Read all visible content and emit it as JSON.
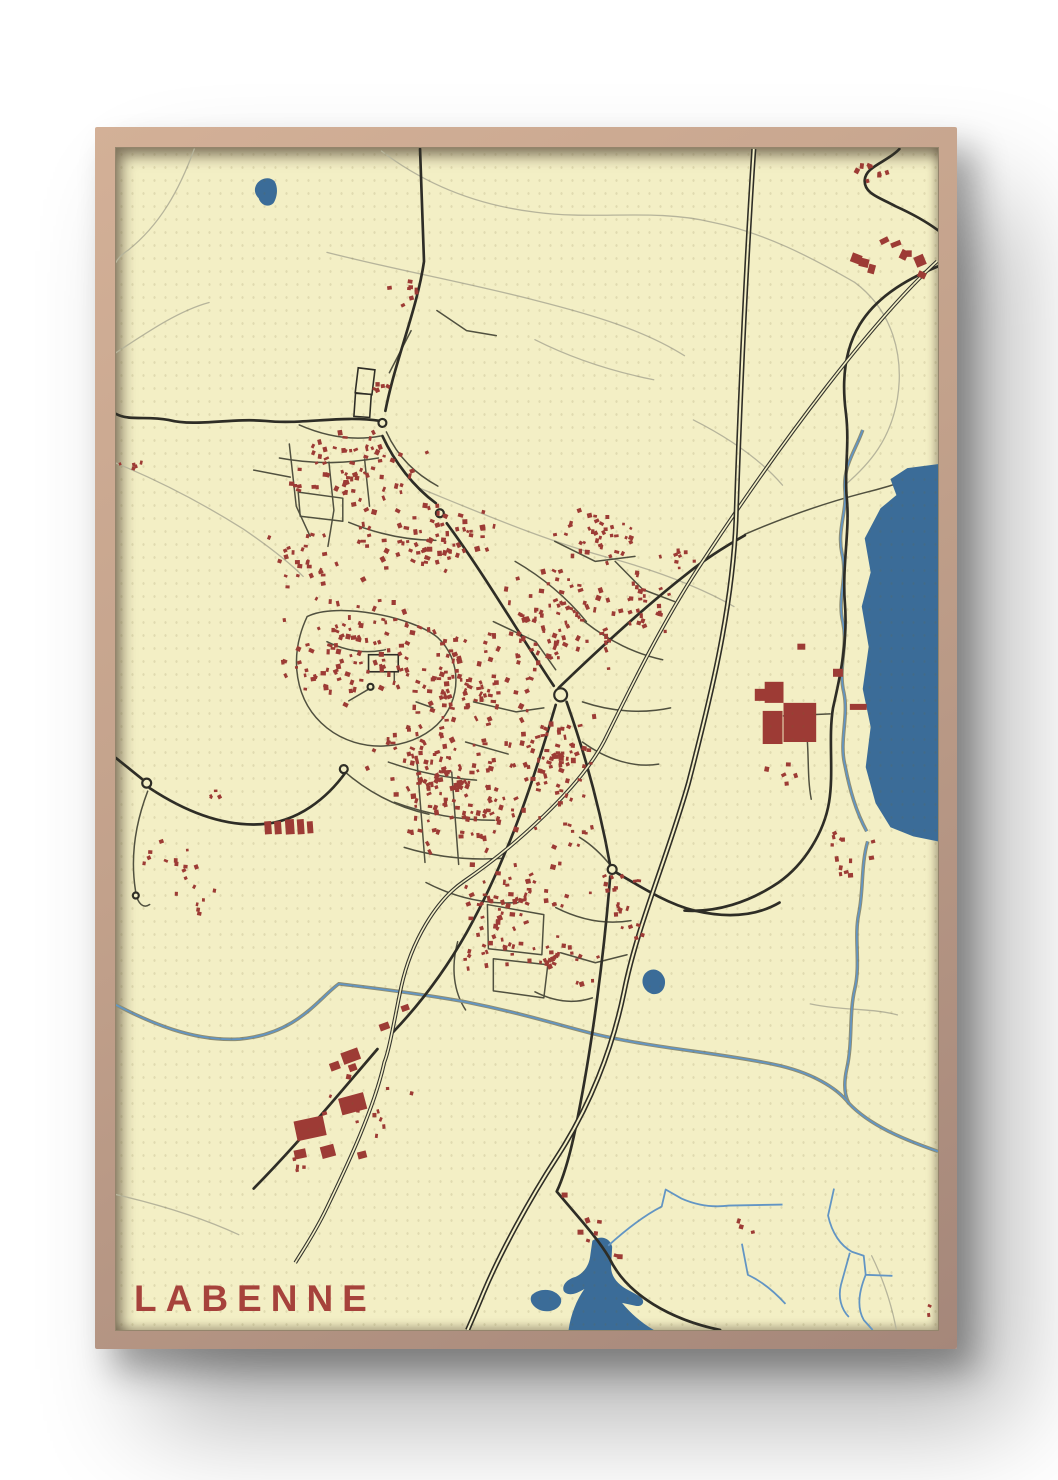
{
  "poster": {
    "title": "LABENNE"
  },
  "colors": {
    "framelight": "#d3b097",
    "framemid": "#c2a18b",
    "framedark": "#a5877a",
    "mapbg": "#f3efc5",
    "trail": "#b6b49b",
    "minor": "#50503f",
    "mainroad": "#2e2d26",
    "rail": "#33332c",
    "water": "#3b6c98",
    "stream": "#6295c4",
    "rivercase": "#8e8d72",
    "building": "#9d3b35",
    "title": "#a6423b"
  },
  "map": {
    "viewBox": "117 149 830 1178",
    "trails": [
      "M385,152 C430,186 481,206 541,213 C601,221 661,209 719,223 C771,233 821,259 863,283",
      "M863,283 C901,311 913,356 906,399 C899,439 879,463 853,485",
      "M330,253 C401,271 471,283 541,301 C601,316 651,331 691,356",
      "M421,487 C481,511 551,541 621,559 C671,573 711,589 741,606",
      "M117,463 C161,481 201,501 246,529 C271,546 291,561 306,576",
      "M196,150 C181,191 161,226 129,251 C123,255 119,259 117,263",
      "M117,353 C151,331 181,311 211,303",
      "M117,1192 C161,1202 206,1216 241,1232",
      "M880,1253 C893,1279 901,1306 905,1327",
      "M818,1002 C851,1009 881,1006 906,1013",
      "M540,340 C580,360 620,372 660,380",
      "M700,420 C740,440 770,462 790,485"
    ],
    "minor_roads": [
      "M302,425 C330,437 358,441 384,436",
      "M282,458 C320,465 352,463 382,458",
      "M292,444 L299,506 L313,536",
      "M332,462 L337,510 L331,546",
      "M368,459 L373,506",
      "M256,470 L293,477",
      "M301,492 L346,498 L346,521 L303,516 Z",
      "M390,432 C402,458 420,474 442,486",
      "M352,522 C382,534 412,540 440,540",
      "M310,616 C291,656 297,701 330,727 C363,753 413,750 441,724 C467,699 466,659 442,637 C417,616 339,601 310,616 Z",
      "M352,700 L371,689",
      "M398,681 L398,661",
      "M420,701 L437,707",
      "M330,641 C351,651 371,653 389,649",
      "M392,761 C421,771 451,777 481,779",
      "M398,801 C431,813 466,819 499,819",
      "M408,846 C441,856 473,859 506,857",
      "M421,761 L429,861",
      "M456,771 L463,863",
      "M430,881 C461,897 493,903 523,901",
      "M520,561 C548,577 572,597 592,621",
      "M560,541 L601,561 L641,556",
      "M590,621 C616,641 641,653 669,659",
      "M588,701 C618,711 649,713 677,707",
      "M588,741 C613,759 641,767 665,763",
      "M621,561 L649,589 L681,601",
      "M498,621 L541,641 L561,669",
      "M478,701 L521,711 L549,707",
      "M470,741 L513,753",
      "M492,903 L549,913 L547,953 L493,947 Z",
      "M498,957 L553,963 L549,996 L498,989 Z",
      "M561,906 C587,919 613,923 637,919",
      "M566,951 L601,961 L633,953",
      "M346,769 C371,791 401,806 433,813",
      "M149,790 C137,821 131,856 137,891 C139,903 145,907 151,903",
      "M415,331 L393,373",
      "M441,311 L471,331 L501,336",
      "M752,534 C792,517 832,503 871,493 C896,487 921,479 941,471",
      "M812,716 C818,746 814,772 819,798",
      "M838,713 L791,715",
      "M585,836 C600,845 610,856 618,866",
      "M462,940 C455,966 458,990 470,1008",
      "M540,990 C560,1000 580,1002 598,996"
    ],
    "main_roads": [
      "M424,150 L428,262 C421,310 399,360 389,411",
      "M386,436 C398,462 418,487 440,503",
      "M451,523 C487,571 525,635 559,685",
      "M561,704 C541,771 516,851 471,931 C451,966 426,1000 396,1031",
      "M381,1047 C341,1093 301,1141 256,1186",
      "M572,701 C592,757 606,809 616,864",
      "M622,871 C656,891 677,903 701,909 C731,916 761,916 787,901",
      "M616,875 C610,951 598,1041 584,1111 C575,1159 566,1181 562,1189 C584,1215 603,1235 615,1255 C633,1293 679,1317 727,1327",
      "M564,687 C606,647 650,607 694,573 C714,557 734,545 752,535",
      "M117,757 L146,780",
      "M151,787 C191,813 229,825 263,823 C301,821 331,796 349,771",
      "M947,267 C912,281 884,299 868,325 C852,351 850,383 854,413 C858,445 852,471 855,499 C858,531 850,566 853,603 C856,641 848,677 841,707 C836,737 842,771 837,801 C832,831 812,863 786,881 C756,901 723,911 691,909",
      "M908,150 C896,163 874,167 873,181 C872,195 890,199 904,207 C922,215 936,223 947,231",
      "M384,421 C344,415 306,425 268,421 C232,418 198,427 170,420 C148,416 130,421 117,414"
    ],
    "highway": "M761,150 C753,270 747,400 743,520 C739,612 716,702 695,782 C673,858 643,925 630,990 C618,1048 595,1105 562,1155 C535,1196 505,1250 488,1290 C481,1307 476,1318 472,1327",
    "railway": "M946,262 C880,322 790,440 710,560 C672,616 640,680 610,740 C585,787 520,845 468,880 C440,899 415,940 405,985 C398,1018 393,1048 388,1060 C378,1105 352,1160 330,1205 C318,1230 306,1247 298,1260",
    "rivers": [
      "M871,430 C863,452 851,466 853,490 C855,512 845,530 850,553 C856,577 845,598 851,622 C856,646 846,668 852,692 C857,716 847,740 853,764 C858,789 864,810 875,830",
      "M876,840 C869,864 872,888 867,912 C862,936 869,962 863,987 C857,1012 861,1040 855,1066 C851,1084 853,1094 857,1101",
      "M117,1003 C150,1020 195,1040 242,1037 C300,1032 322,996 342,982 C375,986 420,991 470,1000 C530,1012 560,1022 600,1032 C660,1046 720,1050 780,1062 C820,1070 845,1086 857,1101 C878,1123 912,1137 947,1149"
    ],
    "streams": [
      "M614,1243 C632,1227 652,1212 668,1204 L672,1187 L688,1196 C704,1203 720,1205 736,1203 L790,1202",
      "M842,1186 L836,1213 C840,1231 849,1243 860,1249 L872,1253 L874,1272 L901,1273",
      "M874,1272 C867,1289 865,1305 872,1317 L881,1327",
      "M858,1250 L849,1282 C846,1294 849,1306 857,1314",
      "M793,1301 C781,1288 768,1278 755,1272 L749,1241"
    ],
    "water_polygons": [
      "M947,464 L916,468 L899,479 L905,495 L889,508 L873,538 L879,572 L870,606 L877,646 L871,688 L879,726 L874,766 L884,802 L899,826 L922,835 L947,840 Z",
      "M259,185 C263,179 272,177 277,182 C281,188 280,198 276,204 C271,209 263,206 261,199 C257,195 256,190 259,185 Z",
      "M651,972 C658,964 668,968 671,977 C673,986 667,994 658,992 C649,989 646,979 651,972 Z",
      "M598,1238 C606,1232 616,1235 618,1244 L617,1262 C616,1272 622,1280 632,1286 L645,1293 C652,1297 650,1304 642,1303 L628,1300 C636,1310 648,1320 660,1327 L574,1327 C576,1312 582,1297 590,1286 C582,1291 573,1294 569,1288 C567,1282 573,1276 581,1274 C590,1270 595,1262 596,1252 Z",
      "M537,1292 C546,1284 561,1286 566,1295 C569,1303 559,1310 548,1308 C539,1306 533,1298 537,1292 Z"
    ],
    "nodes": [
      [
        386,
        423,
        4
      ],
      [
        444,
        513,
        4
      ],
      [
        566,
        694,
        6.5
      ],
      [
        148,
        782,
        4.5
      ],
      [
        347,
        768,
        4
      ],
      [
        618,
        868,
        4.5
      ],
      [
        374,
        686,
        3
      ],
      [
        398,
        659,
        3
      ],
      [
        137,
        894,
        3
      ]
    ],
    "white_rects": [
      [
        360,
        369,
        17,
        25,
        7
      ],
      [
        358,
        394,
        16,
        23,
        4
      ],
      [
        372,
        654,
        30,
        17,
        0
      ]
    ],
    "large_buildings": [
      [
        772,
        681,
        19,
        21,
        0
      ],
      [
        791,
        702,
        33,
        39,
        0
      ],
      [
        770,
        710,
        20,
        33,
        0
      ],
      [
        762,
        688,
        12,
        12,
        0
      ],
      [
        841,
        668,
        10,
        8,
        0
      ],
      [
        858,
        703,
        17,
        6,
        0
      ],
      [
        805,
        643,
        8,
        6,
        0
      ],
      [
        345,
        1048,
        18,
        12,
        -20
      ],
      [
        333,
        1060,
        10,
        8,
        -20
      ],
      [
        352,
        1062,
        8,
        7,
        -20
      ],
      [
        343,
        1093,
        26,
        17,
        -15
      ],
      [
        298,
        1116,
        30,
        20,
        -12
      ],
      [
        324,
        1143,
        14,
        12,
        -15
      ],
      [
        297,
        1147,
        12,
        9,
        -12
      ],
      [
        361,
        1149,
        9,
        7,
        -15
      ],
      [
        383,
        1021,
        10,
        7,
        -20
      ],
      [
        405,
        1003,
        8,
        6,
        -20
      ],
      [
        267,
        820,
        7,
        13,
        -4
      ],
      [
        277,
        820,
        7,
        13,
        -4
      ],
      [
        288,
        818,
        9,
        15,
        -4
      ],
      [
        300,
        818,
        7,
        15,
        -4
      ],
      [
        310,
        820,
        6,
        12,
        -4
      ],
      [
        567,
        1190,
        6,
        5,
        0
      ],
      [
        583,
        1227,
        6,
        5,
        0
      ]
    ],
    "building_clusters": [
      {
        "cx": 358,
        "cy": 468,
        "rx": 75,
        "ry": 42,
        "n": 64,
        "s": [
          2.5,
          5.5
        ]
      },
      {
        "cx": 432,
        "cy": 538,
        "rx": 85,
        "ry": 45,
        "n": 76,
        "s": [
          2.5,
          5.5
        ]
      },
      {
        "cx": 356,
        "cy": 650,
        "rx": 80,
        "ry": 58,
        "n": 88,
        "s": [
          2.5,
          5.5
        ]
      },
      {
        "cx": 468,
        "cy": 680,
        "rx": 78,
        "ry": 66,
        "n": 105,
        "s": [
          2.5,
          5.5
        ]
      },
      {
        "cx": 558,
        "cy": 618,
        "rx": 68,
        "ry": 58,
        "n": 78,
        "s": [
          2.5,
          5.5
        ]
      },
      {
        "cx": 478,
        "cy": 798,
        "rx": 88,
        "ry": 58,
        "n": 95,
        "s": [
          2.5,
          5.5
        ]
      },
      {
        "cx": 560,
        "cy": 758,
        "rx": 58,
        "ry": 52,
        "n": 66,
        "s": [
          2.5,
          5.5
        ]
      },
      {
        "cx": 428,
        "cy": 758,
        "rx": 58,
        "ry": 48,
        "n": 56,
        "s": [
          2.5,
          5.5
        ]
      },
      {
        "cx": 518,
        "cy": 898,
        "rx": 68,
        "ry": 44,
        "n": 56,
        "s": [
          2.5,
          5.5
        ]
      },
      {
        "cx": 602,
        "cy": 538,
        "rx": 48,
        "ry": 38,
        "n": 36,
        "s": [
          2.5,
          5
        ]
      },
      {
        "cx": 644,
        "cy": 600,
        "rx": 38,
        "ry": 38,
        "n": 28,
        "s": [
          2.5,
          5
        ]
      },
      {
        "cx": 300,
        "cy": 560,
        "rx": 42,
        "ry": 34,
        "n": 26,
        "s": [
          2.5,
          5
        ]
      },
      {
        "cx": 558,
        "cy": 958,
        "rx": 48,
        "ry": 34,
        "n": 26,
        "s": [
          2.5,
          5
        ]
      },
      {
        "cx": 618,
        "cy": 898,
        "rx": 34,
        "ry": 28,
        "n": 16,
        "s": [
          2.5,
          5
        ]
      },
      {
        "cx": 893,
        "cy": 256,
        "rx": 42,
        "ry": 28,
        "n": 9,
        "s": [
          5,
          11
        ]
      },
      {
        "cx": 882,
        "cy": 175,
        "rx": 33,
        "ry": 13,
        "n": 8,
        "s": [
          3,
          5.5
        ]
      },
      {
        "cx": 848,
        "cy": 860,
        "rx": 45,
        "ry": 38,
        "n": 13,
        "s": [
          3,
          5.5
        ]
      },
      {
        "cx": 784,
        "cy": 770,
        "rx": 24,
        "ry": 14,
        "n": 5,
        "s": [
          3,
          5
        ]
      },
      {
        "cx": 168,
        "cy": 856,
        "rx": 38,
        "ry": 26,
        "n": 12,
        "s": [
          2.5,
          4.5
        ]
      },
      {
        "cx": 196,
        "cy": 900,
        "rx": 28,
        "ry": 18,
        "n": 7,
        "s": [
          2.5,
          4.5
        ]
      },
      {
        "cx": 408,
        "cy": 296,
        "rx": 36,
        "ry": 16,
        "n": 8,
        "s": [
          3,
          5
        ]
      },
      {
        "cx": 372,
        "cy": 1105,
        "rx": 55,
        "ry": 48,
        "n": 12,
        "s": [
          2.5,
          5
        ]
      },
      {
        "cx": 600,
        "cy": 1240,
        "rx": 48,
        "ry": 42,
        "n": 6,
        "s": [
          3,
          5.5
        ]
      },
      {
        "cx": 938,
        "cy": 1310,
        "rx": 7,
        "ry": 12,
        "n": 3,
        "s": [
          2.5,
          4
        ]
      },
      {
        "cx": 750,
        "cy": 1228,
        "rx": 14,
        "ry": 10,
        "n": 3,
        "s": [
          3,
          5
        ]
      },
      {
        "cx": 640,
        "cy": 930,
        "rx": 22,
        "ry": 16,
        "n": 5,
        "s": [
          2.5,
          4.5
        ]
      },
      {
        "cx": 143,
        "cy": 468,
        "rx": 26,
        "ry": 12,
        "n": 5,
        "s": [
          2.5,
          4.5
        ]
      },
      {
        "cx": 585,
        "cy": 835,
        "rx": 28,
        "ry": 18,
        "n": 8,
        "s": [
          2.5,
          4.5
        ]
      },
      {
        "cx": 500,
        "cy": 945,
        "rx": 34,
        "ry": 26,
        "n": 18,
        "s": [
          2.5,
          5
        ]
      },
      {
        "cx": 210,
        "cy": 792,
        "rx": 18,
        "ry": 8,
        "n": 4,
        "s": [
          2.5,
          4
        ]
      },
      {
        "cx": 300,
        "cy": 1165,
        "rx": 30,
        "ry": 14,
        "n": 4,
        "s": [
          2.5,
          4.5
        ]
      },
      {
        "cx": 680,
        "cy": 560,
        "rx": 28,
        "ry": 22,
        "n": 9,
        "s": [
          2.5,
          4.5
        ]
      },
      {
        "cx": 390,
        "cy": 390,
        "rx": 20,
        "ry": 14,
        "n": 5,
        "s": [
          2.5,
          4.5
        ]
      }
    ]
  }
}
